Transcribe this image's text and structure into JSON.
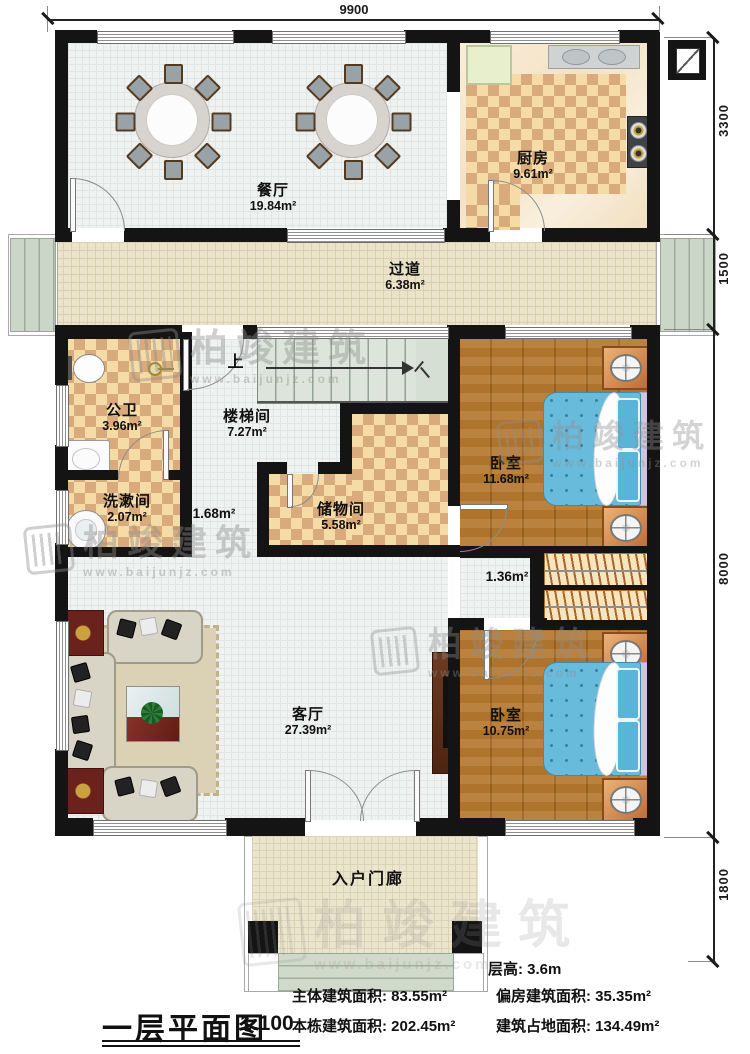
{
  "meta": {
    "drawing_title": "一层平面图",
    "scale": "1:100"
  },
  "dimensions": {
    "top": "9900",
    "right": [
      "3300",
      "1500",
      "8000",
      "1800"
    ]
  },
  "rooms": {
    "dining": {
      "name": "餐厅",
      "area": "19.84m²"
    },
    "kitchen": {
      "name": "厨房",
      "area": "9.61m²"
    },
    "hallway": {
      "name": "过道",
      "area": "6.38m²"
    },
    "bath": {
      "name": "公卫",
      "area": "3.96m²"
    },
    "stair": {
      "name": "楼梯间",
      "area": "7.27m²"
    },
    "wash": {
      "name": "洗漱间",
      "area": "2.07m²"
    },
    "storage": {
      "name": "储物间",
      "area": "5.58m²"
    },
    "bedroom1": {
      "name": "卧室",
      "area": "11.68m²"
    },
    "living": {
      "name": "客厅",
      "area": "27.39m²"
    },
    "bedroom2": {
      "name": "卧室",
      "area": "10.75m²"
    },
    "porch": {
      "name": "入户门廊"
    }
  },
  "labels": {
    "corridor1": "1.68m²",
    "corridor2": "1.36m²",
    "stairs_up": "上"
  },
  "info": {
    "floor_height": "层高: 3.6m",
    "main_area": "主体建筑面积: 83.55m²",
    "side_area": "偏房建筑面积: 35.35m²",
    "building_area": "本栋建筑面积: 202.45m²",
    "footprint_area": "建筑占地面积: 134.49m²"
  },
  "watermark": {
    "brand": "柏竣建筑",
    "url": "www.baijunjz.com"
  },
  "colors": {
    "wall": "#141414",
    "checker_light": "#f5dca6",
    "checker_dark": "#d8aa7c",
    "wood": "#b5792f",
    "bed_blue": "#69bbdc",
    "accent_red": "#6b211c"
  }
}
